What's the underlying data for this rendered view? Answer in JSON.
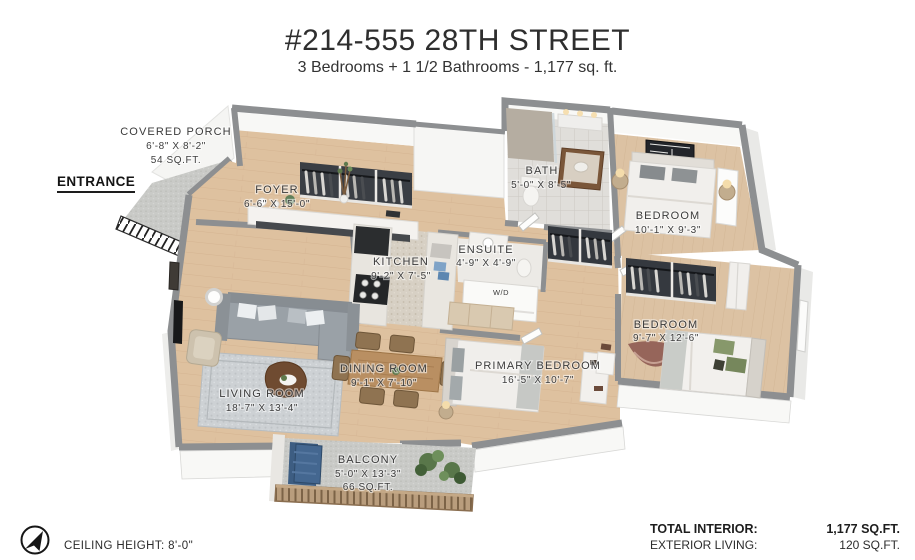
{
  "header": {
    "title": "#214-555 28TH STREET",
    "subtitle": "3 Bedrooms +  1 1/2 Bathrooms - 1,177 sq. ft."
  },
  "annotations": {
    "entrance": "ENTRANCE",
    "ceiling": "CEILING HEIGHT: 8'-0\"",
    "laundry": "W/D",
    "compass_icon": "north-arrow"
  },
  "rooms": {
    "covered_porch": {
      "name": "COVERED PORCH",
      "dims": "6'-8\" X 8'-2\"",
      "area": "54 SQ.FT."
    },
    "foyer": {
      "name": "FOYER",
      "dims": "6'-6\" X 15'-0\""
    },
    "bath": {
      "name": "BATH",
      "dims": "5'-0\" X 8'-5\""
    },
    "bedroom_top": {
      "name": "BEDROOM",
      "dims": "10'-1\" X 9'-3\""
    },
    "kitchen": {
      "name": "KITCHEN",
      "dims": "9'-2\" X 7'-5\""
    },
    "ensuite": {
      "name": "ENSUITE",
      "dims": "4'-9\" X 4'-9\""
    },
    "bedroom_right": {
      "name": "BEDROOM",
      "dims": "9'-7\" X 12'-6\""
    },
    "living_room": {
      "name": "LIVING ROOM",
      "dims": "18'-7\" X 13'-4\""
    },
    "dining_room": {
      "name": "DINING ROOM",
      "dims": "9'-1\" X 7'-10\""
    },
    "primary_bedroom": {
      "name": "PRIMARY BEDROOM",
      "dims": "16'-5\" X 10'-7\""
    },
    "balcony": {
      "name": "BALCONY",
      "dims": "5'-0\" X 13'-3\"",
      "area": "66 SQ.FT."
    }
  },
  "totals": {
    "interior_label": "TOTAL INTERIOR:",
    "interior_value": "1,177 SQ.FT.",
    "exterior_label": "EXTERIOR LIVING:",
    "exterior_value": "120 SQ.FT."
  },
  "colors": {
    "wood": "#debf9e",
    "walls": "#8d8f91",
    "concrete": "#c8c9c6",
    "accent_blue": "#3d5d82",
    "plant_green": "#5f7a4d",
    "label_text": "#3b3b3b"
  }
}
